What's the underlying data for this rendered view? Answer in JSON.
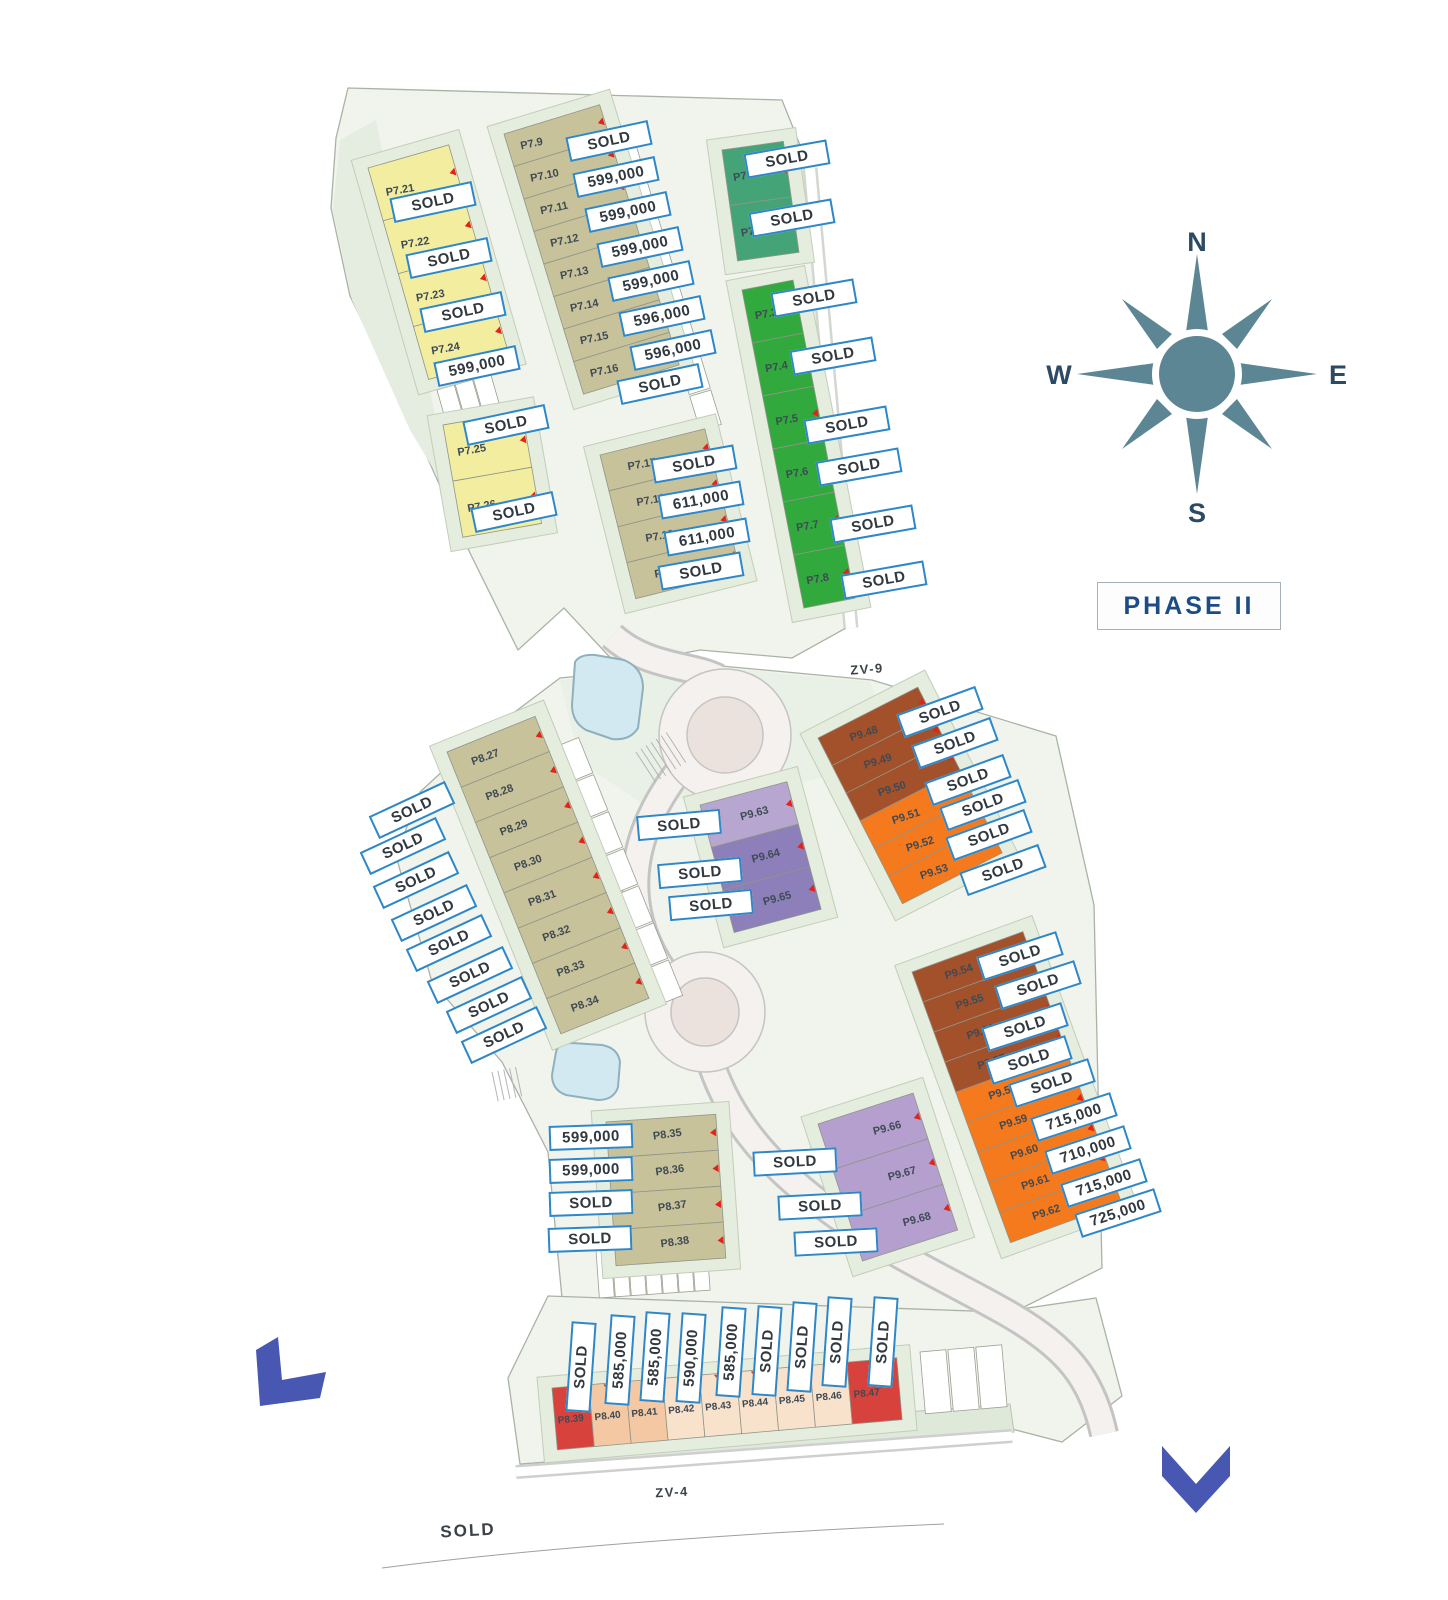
{
  "phase_label": "PHASE II",
  "compass": {
    "n": "N",
    "e": "E",
    "s": "S",
    "w": "W"
  },
  "road_labels": [
    {
      "text": "ZV-9",
      "x": 867,
      "y": 669,
      "rot": -4
    },
    {
      "text": "ZV-4",
      "x": 672,
      "y": 1492,
      "rot": -3
    }
  ],
  "colors": {
    "label_border": "#2d87c8",
    "label_text": "#30393f",
    "yellow": "#f3eda0",
    "olive": "#c8c29a",
    "teal_green": "#45a477",
    "green": "#31a93c",
    "brown": "#a3512a",
    "orange": "#f5791d",
    "purple_light": "#b7a6d0",
    "purple_dark": "#8d7fb9",
    "purple_mid": "#b49fce",
    "red": "#d8423c",
    "peach_dark": "#f3c8a2",
    "peach_light": "#f9e2cb",
    "compass": "#5d8694",
    "arrow_blue": "#4757b2",
    "pool_blue": "#d3e9f2"
  },
  "plot_groups": [
    {
      "name": "p7-yellow-upper",
      "x": 368,
      "y": 168,
      "angle": -16,
      "cell_w": 84,
      "cell_h": 55,
      "id_x": 0.12,
      "id_rot": -10,
      "plots": [
        {
          "id": "P7.21",
          "color": "#f3eda0"
        },
        {
          "id": "P7.22",
          "color": "#f3eda0"
        },
        {
          "id": "P7.23",
          "color": "#f3eda0"
        },
        {
          "id": "P7.24",
          "color": "#f3eda0"
        }
      ]
    },
    {
      "name": "p7-yellow-lower",
      "x": 443,
      "y": 425,
      "angle": -10,
      "cell_w": 80,
      "cell_h": 57,
      "id_x": 0.12,
      "id_rot": -10,
      "plots": [
        {
          "id": "P7.25",
          "color": "#f3eda0"
        },
        {
          "id": "P7.26",
          "color": "#f3eda0"
        }
      ]
    },
    {
      "name": "p7-olive-upper",
      "x": 504,
      "y": 134,
      "angle": -17,
      "cell_w": 100,
      "cell_h": 34,
      "id_x": 0.12,
      "id_rot": -12,
      "plots": [
        {
          "id": "P7.9",
          "color": "#c8c29a"
        },
        {
          "id": "P7.10",
          "color": "#c8c29a"
        },
        {
          "id": "P7.11",
          "color": "#c8c29a"
        },
        {
          "id": "P7.12",
          "color": "#c8c29a"
        },
        {
          "id": "P7.13",
          "color": "#c8c29a"
        },
        {
          "id": "P7.14",
          "color": "#c8c29a"
        },
        {
          "id": "P7.15",
          "color": "#c8c29a"
        },
        {
          "id": "P7.16",
          "color": "#c8c29a"
        }
      ]
    },
    {
      "name": "p7-olive-lower",
      "x": 600,
      "y": 455,
      "angle": -14,
      "cell_w": 108,
      "cell_h": 37,
      "id_x": 0.22,
      "id_rot": -10,
      "plots": [
        {
          "id": "P7.17",
          "color": "#c8c29a"
        },
        {
          "id": "P7.18",
          "color": "#c8c29a"
        },
        {
          "id": "P7.19",
          "color": "#c8c29a"
        },
        {
          "id": "P7.20",
          "color": "#c8c29a"
        }
      ]
    },
    {
      "name": "p7-teal",
      "x": 722,
      "y": 150,
      "angle": -8,
      "cell_w": 62,
      "cell_h": 56,
      "id_x": 0.12,
      "id_rot": -10,
      "plots": [
        {
          "id": "P7.1",
          "color": "#45a477"
        },
        {
          "id": "P7.2",
          "color": "#45a477"
        }
      ]
    },
    {
      "name": "p7-green",
      "x": 742,
      "y": 290,
      "angle": -11,
      "cell_w": 52,
      "cell_h": 54,
      "id_x": 0.15,
      "id_rot": -10,
      "plots": [
        {
          "id": "P7.3",
          "color": "#31a93c"
        },
        {
          "id": "P7.4",
          "color": "#31a93c"
        },
        {
          "id": "P7.5",
          "color": "#31a93c"
        },
        {
          "id": "P7.6",
          "color": "#31a93c"
        },
        {
          "id": "P7.7",
          "color": "#31a93c"
        },
        {
          "id": "P7.8",
          "color": "#31a93c"
        }
      ]
    },
    {
      "name": "p8-olive-mid",
      "x": 447,
      "y": 752,
      "angle": -22,
      "cell_w": 95,
      "cell_h": 38,
      "id_x": 0.2,
      "id_rot": -20,
      "plots": [
        {
          "id": "P8.27",
          "color": "#c8c29a"
        },
        {
          "id": "P8.28",
          "color": "#c8c29a"
        },
        {
          "id": "P8.29",
          "color": "#c8c29a"
        },
        {
          "id": "P8.30",
          "color": "#c8c29a"
        },
        {
          "id": "P8.31",
          "color": "#c8c29a"
        },
        {
          "id": "P8.32",
          "color": "#c8c29a"
        },
        {
          "id": "P8.33",
          "color": "#c8c29a"
        },
        {
          "id": "P8.34",
          "color": "#c8c29a"
        }
      ]
    },
    {
      "name": "p9-purple-upper",
      "x": 700,
      "y": 805,
      "angle": -15,
      "cell_w": 90,
      "cell_h": 44,
      "id_x": 0.4,
      "id_rot": -15,
      "plots": [
        {
          "id": "P9.63",
          "color": "#b7a6d0"
        },
        {
          "id": "P9.64",
          "color": "#8d7fb9"
        },
        {
          "id": "P9.65",
          "color": "#8d7fb9"
        }
      ]
    },
    {
      "name": "p9-brown-orange-upper",
      "x": 818,
      "y": 738,
      "angle": -27,
      "cell_w": 112,
      "cell_h": 31,
      "id_x": 0.25,
      "id_rot": -18,
      "plots": [
        {
          "id": "P9.48",
          "color": "#a3512a"
        },
        {
          "id": "P9.49",
          "color": "#a3512a"
        },
        {
          "id": "P9.50",
          "color": "#a3512a"
        },
        {
          "id": "P9.51",
          "color": "#f5791d"
        },
        {
          "id": "P9.52",
          "color": "#f5791d"
        },
        {
          "id": "P9.53",
          "color": "#f5791d"
        }
      ]
    },
    {
      "name": "p9-brown-orange-lower",
      "x": 912,
      "y": 972,
      "angle": -20,
      "cell_w": 118,
      "cell_h": 32,
      "id_x": 0.25,
      "id_rot": -18,
      "plots": [
        {
          "id": "P9.54",
          "color": "#a3512a"
        },
        {
          "id": "P9.55",
          "color": "#a3512a"
        },
        {
          "id": "P9.56",
          "color": "#a3512a"
        },
        {
          "id": "P9.57",
          "color": "#a3512a"
        },
        {
          "id": "P9.58",
          "color": "#f5791d"
        },
        {
          "id": "P9.59",
          "color": "#f5791d"
        },
        {
          "id": "P9.60",
          "color": "#f5791d"
        },
        {
          "id": "P9.61",
          "color": "#f5791d"
        },
        {
          "id": "P9.62",
          "color": "#f5791d"
        }
      ]
    },
    {
      "name": "p8-olive-lower",
      "x": 606,
      "y": 1122,
      "angle": -4,
      "cell_w": 110,
      "cell_h": 36,
      "id_x": 0.42,
      "id_rot": -8,
      "plots": [
        {
          "id": "P8.35",
          "color": "#c8c29a"
        },
        {
          "id": "P8.36",
          "color": "#c8c29a"
        },
        {
          "id": "P8.37",
          "color": "#c8c29a"
        },
        {
          "id": "P8.38",
          "color": "#c8c29a"
        }
      ]
    },
    {
      "name": "p9-purple-lower",
      "x": 818,
      "y": 1124,
      "angle": -18,
      "cell_w": 100,
      "cell_h": 48,
      "id_x": 0.5,
      "id_rot": -15,
      "plots": [
        {
          "id": "P9.66",
          "color": "#b49fce"
        },
        {
          "id": "P9.67",
          "color": "#b49fce"
        },
        {
          "id": "P9.68",
          "color": "#b49fce"
        }
      ]
    },
    {
      "name": "p8-bottom-row",
      "x": 552,
      "y": 1388,
      "angle": -5,
      "dir": "h",
      "cell_w": 37,
      "cell_h": 62,
      "id_x": 0.08,
      "id_rot": -6,
      "id_fs": 10,
      "plots": [
        {
          "id": "P8.39",
          "color": "#d8423c"
        },
        {
          "id": "P8.40",
          "color": "#f3c8a2"
        },
        {
          "id": "P8.41",
          "color": "#f3c8a2"
        },
        {
          "id": "P8.42",
          "color": "#f9e2cb"
        },
        {
          "id": "P8.43",
          "color": "#f9e2cb"
        },
        {
          "id": "P8.44",
          "color": "#f9e2cb"
        },
        {
          "id": "P8.45",
          "color": "#f9e2cb"
        },
        {
          "id": "P8.46",
          "color": "#f9e2cb"
        },
        {
          "id": "P8.47",
          "color": "#d8423c",
          "w": 50
        }
      ]
    }
  ],
  "labels": [
    {
      "for": "P7.9",
      "text": "SOLD",
      "x": 609,
      "y": 141,
      "rot": -12
    },
    {
      "for": "P7.10",
      "text": "599,000",
      "x": 616,
      "y": 177,
      "rot": -12
    },
    {
      "for": "P7.11",
      "text": "599,000",
      "x": 628,
      "y": 212,
      "rot": -12
    },
    {
      "for": "P7.12",
      "text": "599,000",
      "x": 640,
      "y": 247,
      "rot": -12
    },
    {
      "for": "P7.13",
      "text": "599,000",
      "x": 651,
      "y": 281,
      "rot": -12
    },
    {
      "for": "P7.14",
      "text": "596,000",
      "x": 662,
      "y": 316,
      "rot": -12
    },
    {
      "for": "P7.15",
      "text": "596,000",
      "x": 673,
      "y": 350,
      "rot": -12
    },
    {
      "for": "P7.16",
      "text": "SOLD",
      "x": 660,
      "y": 384,
      "rot": -12
    },
    {
      "for": "P7.21",
      "text": "SOLD",
      "x": 433,
      "y": 202,
      "rot": -12
    },
    {
      "for": "P7.22",
      "text": "SOLD",
      "x": 449,
      "y": 258,
      "rot": -12
    },
    {
      "for": "P7.23",
      "text": "SOLD",
      "x": 463,
      "y": 312,
      "rot": -12
    },
    {
      "for": "P7.24",
      "text": "599,000",
      "x": 477,
      "y": 366,
      "rot": -12
    },
    {
      "for": "P7.25",
      "text": "SOLD",
      "x": 506,
      "y": 425,
      "rot": -12
    },
    {
      "for": "P7.26",
      "text": "SOLD",
      "x": 514,
      "y": 512,
      "rot": -12
    },
    {
      "for": "P7.17",
      "text": "SOLD",
      "x": 694,
      "y": 464,
      "rot": -10
    },
    {
      "for": "P7.18",
      "text": "611,000",
      "x": 701,
      "y": 500,
      "rot": -10
    },
    {
      "for": "P7.19",
      "text": "611,000",
      "x": 707,
      "y": 537,
      "rot": -10
    },
    {
      "for": "P7.20",
      "text": "SOLD",
      "x": 701,
      "y": 571,
      "rot": -10
    },
    {
      "for": "P7.1",
      "text": "SOLD",
      "x": 787,
      "y": 159,
      "rot": -10
    },
    {
      "for": "P7.2",
      "text": "SOLD",
      "x": 792,
      "y": 218,
      "rot": -10
    },
    {
      "for": "P7.3",
      "text": "SOLD",
      "x": 814,
      "y": 298,
      "rot": -10
    },
    {
      "for": "P7.4",
      "text": "SOLD",
      "x": 833,
      "y": 356,
      "rot": -10
    },
    {
      "for": "P7.5",
      "text": "SOLD",
      "x": 847,
      "y": 425,
      "rot": -10
    },
    {
      "for": "P7.6",
      "text": "SOLD",
      "x": 859,
      "y": 467,
      "rot": -10
    },
    {
      "for": "P7.7",
      "text": "SOLD",
      "x": 873,
      "y": 524,
      "rot": -10
    },
    {
      "for": "P7.8",
      "text": "SOLD",
      "x": 884,
      "y": 580,
      "rot": -10
    },
    {
      "for": "P8.27",
      "text": "SOLD",
      "x": 412,
      "y": 810,
      "rot": -25
    },
    {
      "for": "P8.28",
      "text": "SOLD",
      "x": 403,
      "y": 846,
      "rot": -25
    },
    {
      "for": "P8.29",
      "text": "SOLD",
      "x": 416,
      "y": 880,
      "rot": -25
    },
    {
      "for": "P8.30",
      "text": "SOLD",
      "x": 434,
      "y": 913,
      "rot": -25
    },
    {
      "for": "P8.31",
      "text": "SOLD",
      "x": 449,
      "y": 943,
      "rot": -25
    },
    {
      "for": "P8.32",
      "text": "SOLD",
      "x": 470,
      "y": 975,
      "rot": -25
    },
    {
      "for": "P8.33",
      "text": "SOLD",
      "x": 489,
      "y": 1005,
      "rot": -25
    },
    {
      "for": "P8.34",
      "text": "SOLD",
      "x": 504,
      "y": 1035,
      "rot": -25
    },
    {
      "for": "P9.63",
      "text": "SOLD",
      "x": 679,
      "y": 825,
      "rot": -5
    },
    {
      "for": "P9.64",
      "text": "SOLD",
      "x": 700,
      "y": 873,
      "rot": -5
    },
    {
      "for": "P9.65",
      "text": "SOLD",
      "x": 711,
      "y": 905,
      "rot": -5
    },
    {
      "for": "P9.48",
      "text": "SOLD",
      "x": 940,
      "y": 712,
      "rot": -20
    },
    {
      "for": "P9.49",
      "text": "SOLD",
      "x": 955,
      "y": 743,
      "rot": -20
    },
    {
      "for": "P9.50",
      "text": "SOLD",
      "x": 968,
      "y": 780,
      "rot": -20
    },
    {
      "for": "P9.51",
      "text": "SOLD",
      "x": 983,
      "y": 805,
      "rot": -20
    },
    {
      "for": "P9.52",
      "text": "SOLD",
      "x": 989,
      "y": 835,
      "rot": -20
    },
    {
      "for": "P9.53",
      "text": "SOLD",
      "x": 1003,
      "y": 870,
      "rot": -20
    },
    {
      "for": "P9.54",
      "text": "SOLD",
      "x": 1020,
      "y": 956,
      "rot": -18
    },
    {
      "for": "P9.55",
      "text": "SOLD",
      "x": 1038,
      "y": 985,
      "rot": -18
    },
    {
      "for": "P9.56",
      "text": "SOLD",
      "x": 1025,
      "y": 1027,
      "rot": -18
    },
    {
      "for": "P9.57",
      "text": "SOLD",
      "x": 1029,
      "y": 1060,
      "rot": -18
    },
    {
      "for": "P9.58",
      "text": "SOLD",
      "x": 1052,
      "y": 1083,
      "rot": -18
    },
    {
      "for": "P9.59",
      "text": "715,000",
      "x": 1074,
      "y": 1117,
      "rot": -18
    },
    {
      "for": "P9.60",
      "text": "710,000",
      "x": 1088,
      "y": 1150,
      "rot": -18
    },
    {
      "for": "P9.61",
      "text": "715,000",
      "x": 1104,
      "y": 1183,
      "rot": -18
    },
    {
      "for": "P9.62",
      "text": "725,000",
      "x": 1118,
      "y": 1213,
      "rot": -18
    },
    {
      "for": "P8.35",
      "text": "599,000",
      "x": 591,
      "y": 1137,
      "rot": -2
    },
    {
      "for": "P8.36",
      "text": "599,000",
      "x": 591,
      "y": 1170,
      "rot": -2
    },
    {
      "for": "P8.37",
      "text": "SOLD",
      "x": 591,
      "y": 1203,
      "rot": -2
    },
    {
      "for": "P8.38",
      "text": "SOLD",
      "x": 590,
      "y": 1239,
      "rot": -2
    },
    {
      "for": "P9.66",
      "text": "SOLD",
      "x": 795,
      "y": 1162,
      "rot": -3
    },
    {
      "for": "P9.67",
      "text": "SOLD",
      "x": 820,
      "y": 1206,
      "rot": -3
    },
    {
      "for": "P9.68",
      "text": "SOLD",
      "x": 836,
      "y": 1242,
      "rot": -3
    },
    {
      "for": "P8.39",
      "text": "SOLD",
      "x": 581,
      "y": 1367,
      "rot": -86,
      "kind": "vbox"
    },
    {
      "for": "P8.40",
      "text": "585,000",
      "x": 620,
      "y": 1360,
      "rot": -86,
      "kind": "vbox"
    },
    {
      "for": "P8.41",
      "text": "585,000",
      "x": 655,
      "y": 1357,
      "rot": -86,
      "kind": "vbox"
    },
    {
      "for": "P8.42",
      "text": "590,000",
      "x": 691,
      "y": 1358,
      "rot": -86,
      "kind": "vbox"
    },
    {
      "for": "P8.43",
      "text": "585,000",
      "x": 731,
      "y": 1352,
      "rot": -86,
      "kind": "vbox"
    },
    {
      "for": "P8.44",
      "text": "SOLD",
      "x": 767,
      "y": 1351,
      "rot": -86,
      "kind": "vbox"
    },
    {
      "for": "P8.45",
      "text": "SOLD",
      "x": 802,
      "y": 1347,
      "rot": -86,
      "kind": "vbox"
    },
    {
      "for": "P8.46",
      "text": "SOLD",
      "x": 837,
      "y": 1342,
      "rot": -86,
      "kind": "vbox"
    },
    {
      "for": "P8.47",
      "text": "SOLD",
      "x": 883,
      "y": 1342,
      "rot": -86,
      "kind": "vbox"
    },
    {
      "for": "zv4-frontage",
      "text": "SOLD",
      "x": 468,
      "y": 1531,
      "rot": -3,
      "kind": "plain"
    }
  ]
}
